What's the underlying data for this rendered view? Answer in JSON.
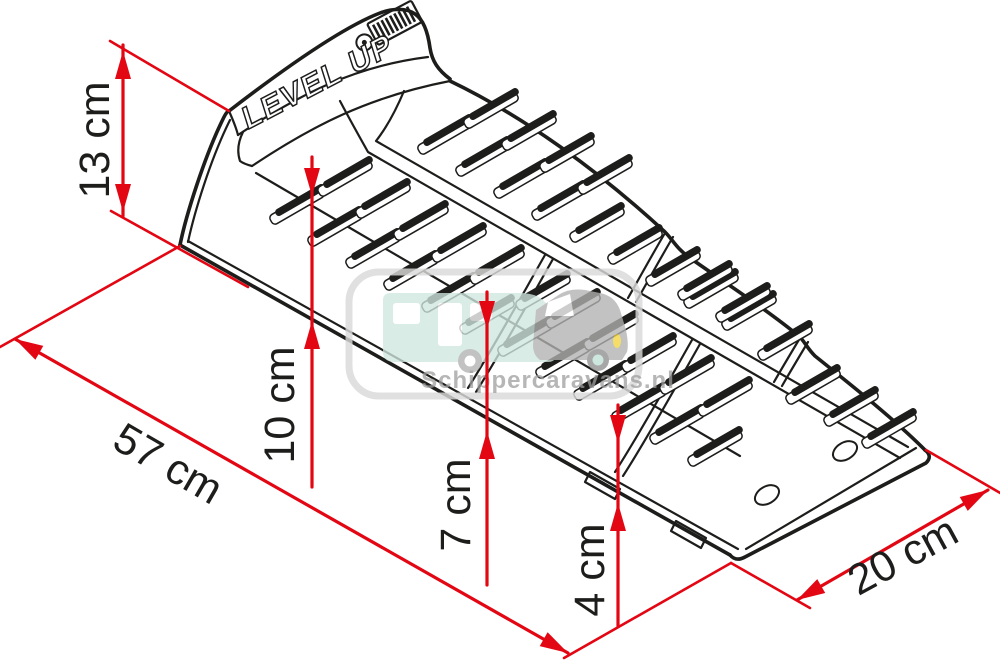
{
  "page": {
    "background": "#ffffff",
    "width": 1000,
    "height": 669
  },
  "product": {
    "name": "LEVEL UP"
  },
  "icons": {
    "brand_logo": "fiamma-stripes-logo"
  },
  "watermark": {
    "text": "Schippercaravans.nl",
    "border_color": "#d9d9d9",
    "caravan_color": "#cfe7de",
    "car_color": "#b2b2b2",
    "window_color": "#ffffff",
    "headlight_color": "#f2d43f",
    "hub_color": "#bfe0d6",
    "text_color": "#9e9e9e"
  },
  "colors": {
    "line": "#1d1d1b",
    "dimension": "#e30613",
    "label": "#1d1d1b"
  },
  "diagram": {
    "title": "Levelling ramp with dimensions",
    "units": "cm",
    "dimensions": [
      {
        "label": "13 cm",
        "value": 13,
        "line": [
          123,
          45,
          123,
          216
        ],
        "arrows": [
          {
            "tip": [
              123,
              51
            ],
            "dir": [
              0,
              -1
            ]
          },
          {
            "tip": [
              123,
              212
            ],
            "dir": [
              0,
              1
            ]
          }
        ],
        "ext": [
          [
            110,
            41,
            229,
            111
          ],
          [
            111,
            211,
            248,
            287
          ]
        ],
        "label_pos": [
          95,
          140
        ],
        "label_rot": -90
      },
      {
        "label": "57 cm",
        "value": 57,
        "line": [
          15,
          339,
          568,
          653
        ],
        "arrows": [
          {
            "tip": [
              15,
              339
            ],
            "dir": [
              -0.869,
              -0.494
            ]
          },
          {
            "tip": [
              568,
              653
            ],
            "dir": [
              0.869,
              0.494
            ]
          }
        ],
        "ext": [
          [
            180,
            246,
            0,
            347
          ],
          [
            731,
            563,
            564,
            658
          ]
        ],
        "label_pos": [
          168,
          464
        ],
        "label_rot": 30
      },
      {
        "label": "10 cm",
        "value": 10,
        "line": [
          312,
          157,
          312,
          487
        ],
        "arrows": [
          {
            "tip": [
              312,
              196
            ],
            "dir": [
              0,
              1
            ]
          },
          {
            "tip": [
              312,
              321
            ],
            "dir": [
              0,
              -1
            ]
          }
        ],
        "ext": [],
        "label_pos": [
          280,
          405
        ],
        "label_rot": -90
      },
      {
        "label": "7 cm",
        "value": 7,
        "line": [
          487,
          292,
          487,
          585
        ],
        "arrows": [
          {
            "tip": [
              487,
              329
            ],
            "dir": [
              0,
              1
            ]
          },
          {
            "tip": [
              487,
              431
            ],
            "dir": [
              0,
              -1
            ]
          }
        ],
        "ext": [],
        "label_pos": [
          456,
          505
        ],
        "label_rot": -90
      },
      {
        "label": "4 cm",
        "value": 4,
        "line": [
          618,
          405,
          618,
          626
        ],
        "arrows": [
          {
            "tip": [
              618,
              443
            ],
            "dir": [
              0,
              1
            ]
          },
          {
            "tip": [
              618,
              503
            ],
            "dir": [
              0,
              -1
            ]
          }
        ],
        "ext": [],
        "label_pos": [
          590,
          570
        ],
        "label_rot": -90
      },
      {
        "label": "20 cm",
        "value": 20,
        "line": [
          797,
          600,
          988,
          490
        ],
        "arrows": [
          {
            "tip": [
              797,
              600
            ],
            "dir": [
              -0.866,
              0.499
            ]
          },
          {
            "tip": [
              988,
              490
            ],
            "dir": [
              0.866,
              -0.499
            ]
          }
        ],
        "ext": [
          [
            731,
            563,
            810,
            608
          ],
          [
            926,
            450,
            1002,
            494
          ]
        ],
        "label_pos": [
          903,
          556
        ],
        "label_rot": -28.5
      }
    ],
    "bar_style": {
      "length": 56,
      "thickness": 7.5,
      "angle": -30
    },
    "bars": [
      [
        300,
        200
      ],
      [
        338,
        222
      ],
      [
        376,
        244
      ],
      [
        414,
        266
      ],
      [
        452,
        288
      ],
      [
        490,
        310
      ],
      [
        528,
        332
      ],
      [
        566,
        354
      ],
      [
        604,
        376
      ],
      [
        642,
        398
      ],
      [
        680,
        420
      ],
      [
        718,
        442
      ],
      [
        348,
        172
      ],
      [
        386,
        194
      ],
      [
        424,
        216
      ],
      [
        462,
        238
      ],
      [
        500,
        260
      ],
      [
        546,
        286
      ],
      [
        576,
        304
      ],
      [
        614,
        326
      ],
      [
        652,
        348
      ],
      [
        690,
        370
      ],
      [
        728,
        392
      ],
      [
        448,
        130
      ],
      [
        486,
        152
      ],
      [
        524,
        174
      ],
      [
        562,
        196
      ],
      [
        600,
        218
      ],
      [
        638,
        240
      ],
      [
        676,
        262
      ],
      [
        714,
        284
      ],
      [
        752,
        306
      ],
      [
        788,
        336
      ],
      [
        816,
        380
      ],
      [
        854,
        402
      ],
      [
        892,
        424
      ],
      [
        494,
        104
      ],
      [
        532,
        126
      ],
      [
        570,
        148
      ],
      [
        608,
        170
      ],
      [
        708,
        276
      ],
      [
        746,
        298
      ]
    ],
    "holes": [
      [
        845,
        451
      ],
      [
        767,
        495
      ]
    ]
  }
}
